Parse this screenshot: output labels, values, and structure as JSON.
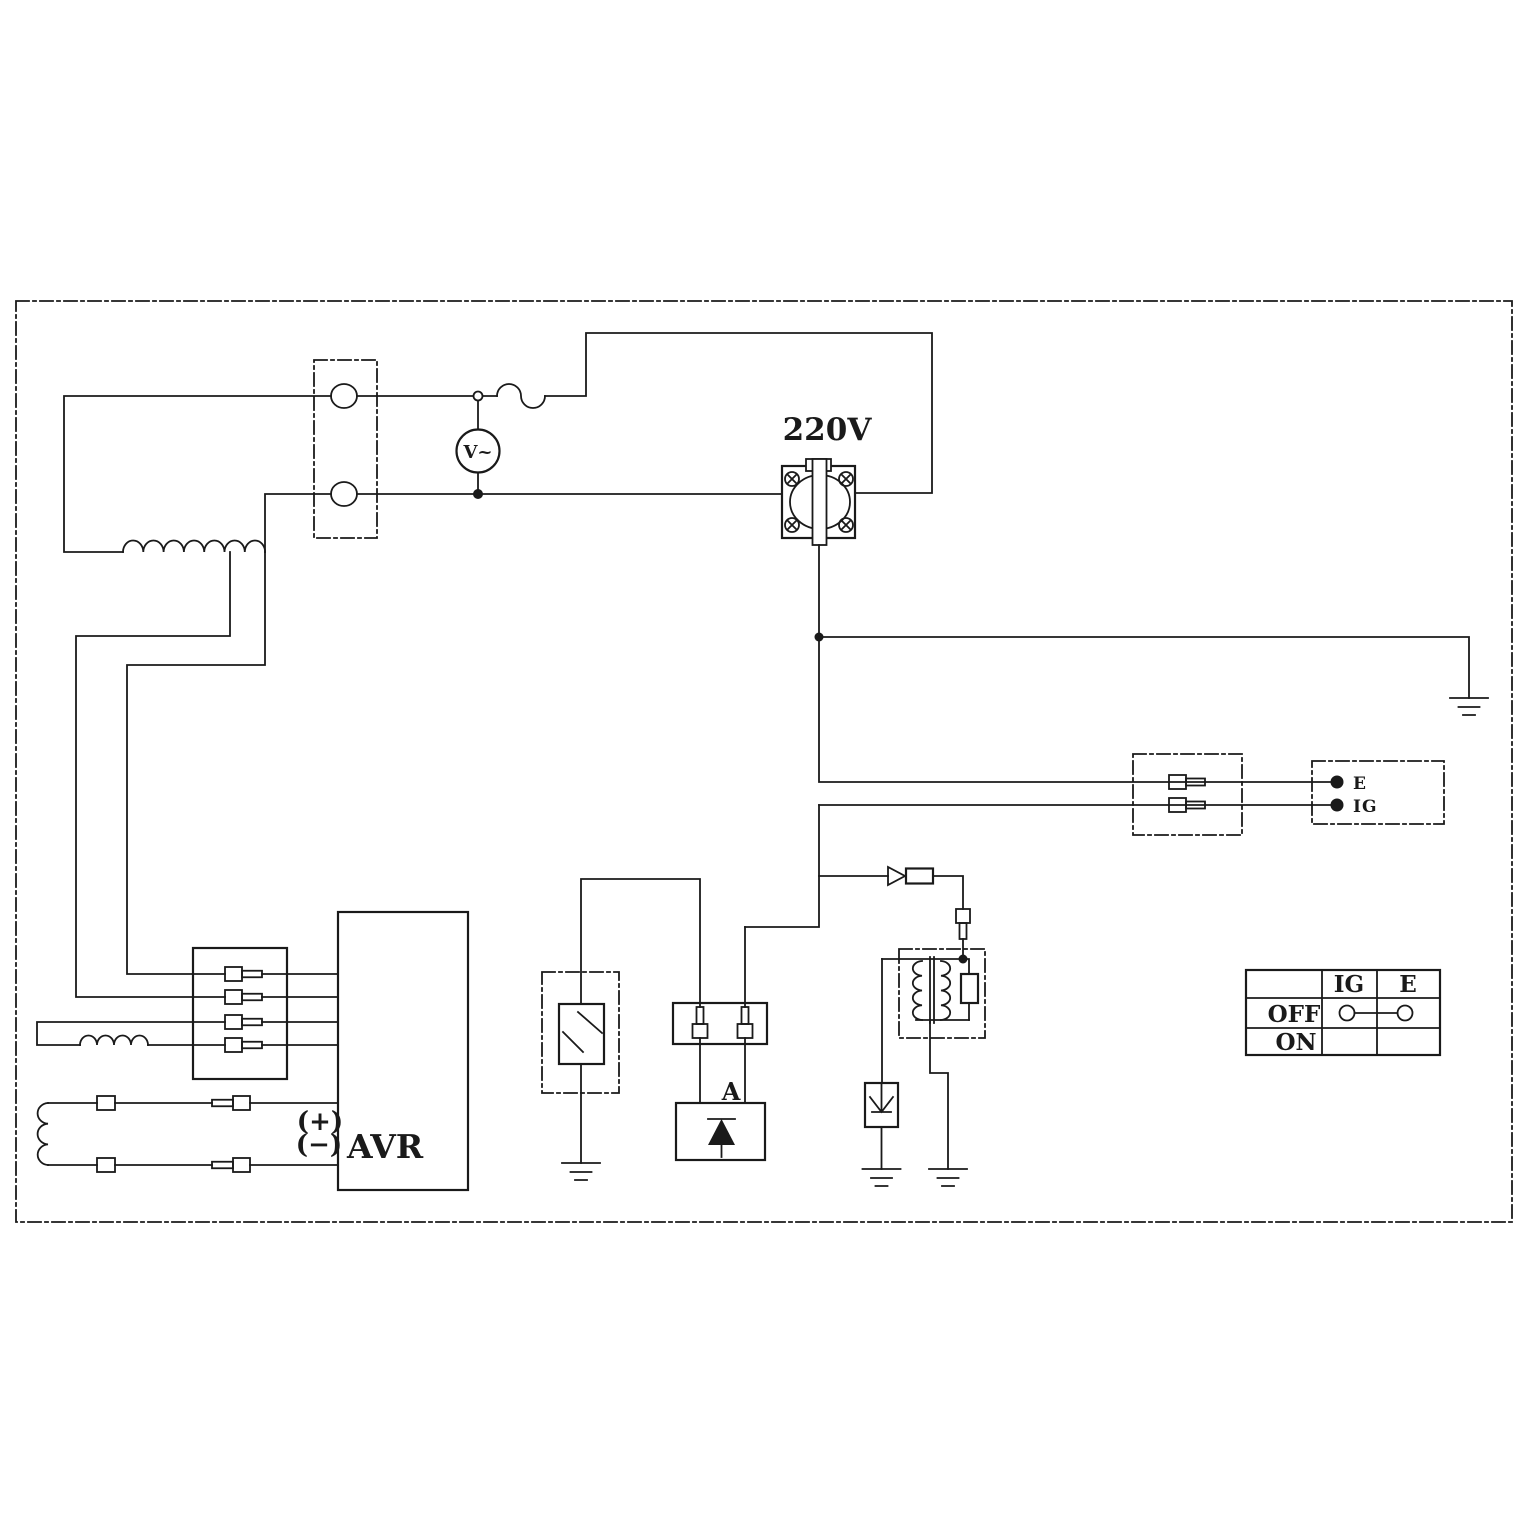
{
  "colors": {
    "line": "#1a1a1a",
    "background": "#ffffff"
  },
  "labels": {
    "receptacle_voltage": "220V",
    "voltmeter": "V~",
    "avr": "AVR",
    "avr_positive": "(+)",
    "avr_negative": "(−)",
    "diode_unit": "A"
  },
  "engine_terminals": {
    "e": "E",
    "ig": "IG"
  },
  "switch_table": {
    "col_ig": "IG",
    "col_e": "E",
    "row_off": "OFF",
    "row_on": "ON"
  }
}
